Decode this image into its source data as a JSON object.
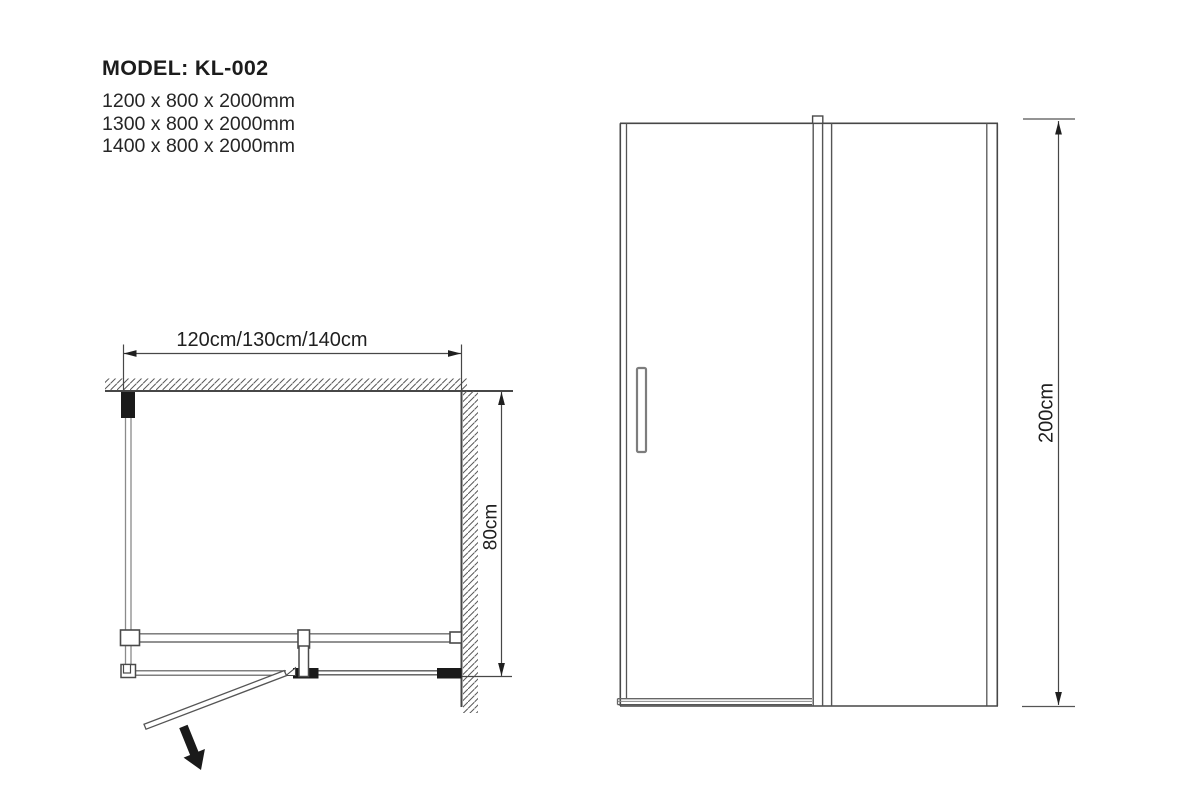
{
  "header": {
    "model_label": "MODEL: KL-002",
    "sizes": [
      "1200 x 800 x 2000mm",
      "1300 x 800 x 2000mm",
      "1400 x 800 x 2000mm"
    ]
  },
  "plan": {
    "width_label": "120cm/130cm/140cm",
    "depth_label": "80cm"
  },
  "elevation": {
    "height_label": "200cm"
  },
  "colors": {
    "line": "#474747",
    "light_line": "#8a8a8a",
    "black_fill": "#1a1a1a",
    "background": "#ffffff"
  }
}
